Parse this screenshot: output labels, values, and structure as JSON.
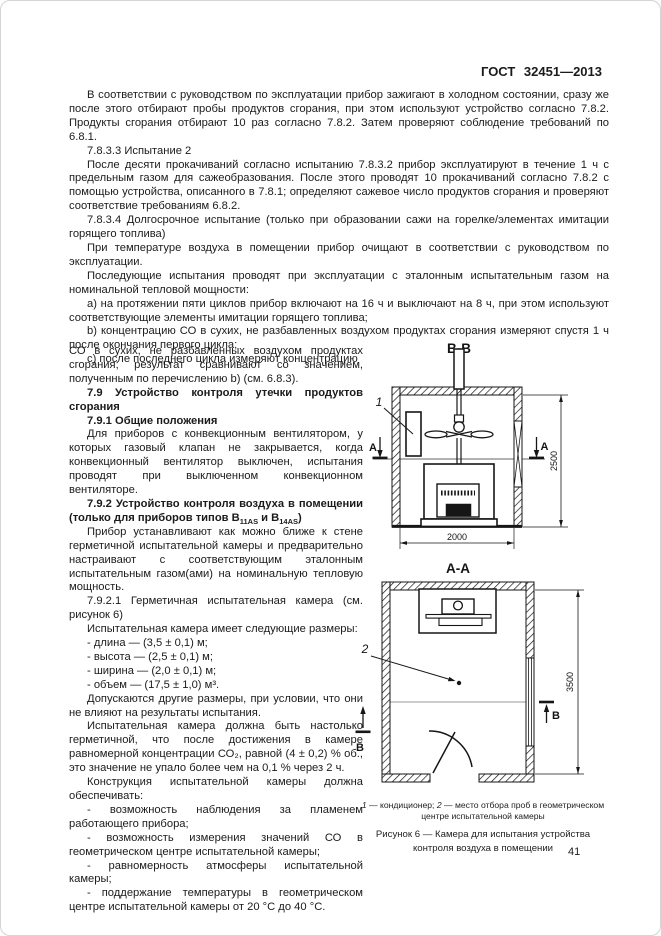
{
  "header": {
    "doc_code": "ГОСТ 32451—2013"
  },
  "page_number": "41",
  "full_text": {
    "p1": "В соответствии с руководством по эксплуатации прибор зажигают в холодном состоянии, сразу же после этого отбирают пробы продуктов сгорания, при этом используют устройство согласно 7.8.2. Продукты сгорания отбирают 10 раз согласно 7.8.2. Затем проверяют соблюдение требований по 6.8.1.",
    "p2": "7.8.3.3  Испытание 2",
    "p3": "После десяти прокачиваний согласно испытанию 7.8.3.2 прибор эксплуатируют в течение 1 ч с предельным газом для сажеобразования. После этого проводят 10 прокачиваний согласно 7.8.2 с помощью устройства, описанного в 7.8.1; определяют сажевое число продуктов сгорания и проверяют соответствие требованиям 6.8.2.",
    "p4": "7.8.3.4  Долгосрочное испытание (только при образовании сажи на горелке/элементах имитации горящего топлива)",
    "p5": "При температуре воздуха в помещении прибор очищают в соответствии с руководством по эксплуатации.",
    "p6": "Последующие испытания проводят при эксплуатации с эталонным испытательным газом на номинальной тепловой мощности:",
    "p7": "a)  на протяжении пяти циклов прибор включают на 16 ч и выключают на 8 ч, при этом используют соответствующие элементы имитации горящего топлива;",
    "p8": "b)  концентрацию СО в сухих, не разбавленных воздухом продуктах сгорания измеряют спустя 1 ч после окончания первого цикла;",
    "p9": "c)  после последнего цикла измеряют концентрацию"
  },
  "left_column": {
    "p1": "СО в сухих, не разбавленных воздухом продуктах сгорания; результат сравнивают со значением, полученным по перечислению b) (см. 6.8.3).",
    "h79": "7.9  Устройство контроля утечки продуктов сгорания",
    "h791": "7.9.1  Общие положения",
    "p2": "Для приборов с конвекционным вентилятором, у которых газовый клапан не закрывается, когда конвекционный вентилятор выключен, испытания проводят при выключенном конвекционном вентиляторе.",
    "h792_pre": "7.9.2  Устройство контроля воздуха в помещении (только для приборов типов В",
    "h792_sub1": "11AS",
    "h792_mid": " и В",
    "h792_sub2": "14AS",
    "h792_post": ")",
    "p3": "Прибор устанавливают как можно ближе к стене герметичной испытательной камеры и предварительно настраивают с соответствующим эталонным испытательным газом(ами) на номинальную тепловую мощность.",
    "p4": "7.9.2.1 Герметичная испытательная камера (см. рисунок 6)",
    "p5": "Испытательная камера имеет следующие размеры:",
    "li1": "-  длина — (3,5 ± 0,1) м;",
    "li2": "-  высота — (2,5 ± 0,1) м;",
    "li3": "-  ширина — (2,0 ± 0,1) м;",
    "li4": "-  объем — (17,5 ± 1,0) м³.",
    "p6": "Допускаются другие размеры, при условии, что они не влияют на результаты испытания.",
    "p7": "Испытательная камера должна быть настолько герметичной, что после достижения в камере равномерной концентрации СО₂, равной (4 ± 0,2) % об., это значение не упало более чем на 0,1 % через 2 ч.",
    "p8": "Конструкция испытательной камеры должна обеспечивать:",
    "li5": "-  возможность наблюдения за пламенем работающего прибора;",
    "li6": "-  возможность измерения значений СО в геометрическом центре испытательной камеры;",
    "li7": "-  равномерность атмосферы испытательной камеры;",
    "li8": "-  поддержание температуры в геометрическом центре испытательной камеры от 20 °С до 40 °С."
  },
  "figure": {
    "section_bb_title": "В-В",
    "section_aa_title": "А-А",
    "dim_width": "2000",
    "dim_height": "2500",
    "dim_length": "3500",
    "callout_1": "1",
    "callout_2": "2",
    "marker_a_left": "А",
    "marker_a_right": "А",
    "marker_b_left": "В",
    "marker_b_right": "В",
    "legend_n1": "1",
    "legend_t1": " — кондиционер; ",
    "legend_n2": "2",
    "legend_t2": " — место отбора проб в геометрическом центре испытательной камеры",
    "caption": "Рисунок 6 — Камера для испытания устройства контроля воздуха в помещении"
  }
}
